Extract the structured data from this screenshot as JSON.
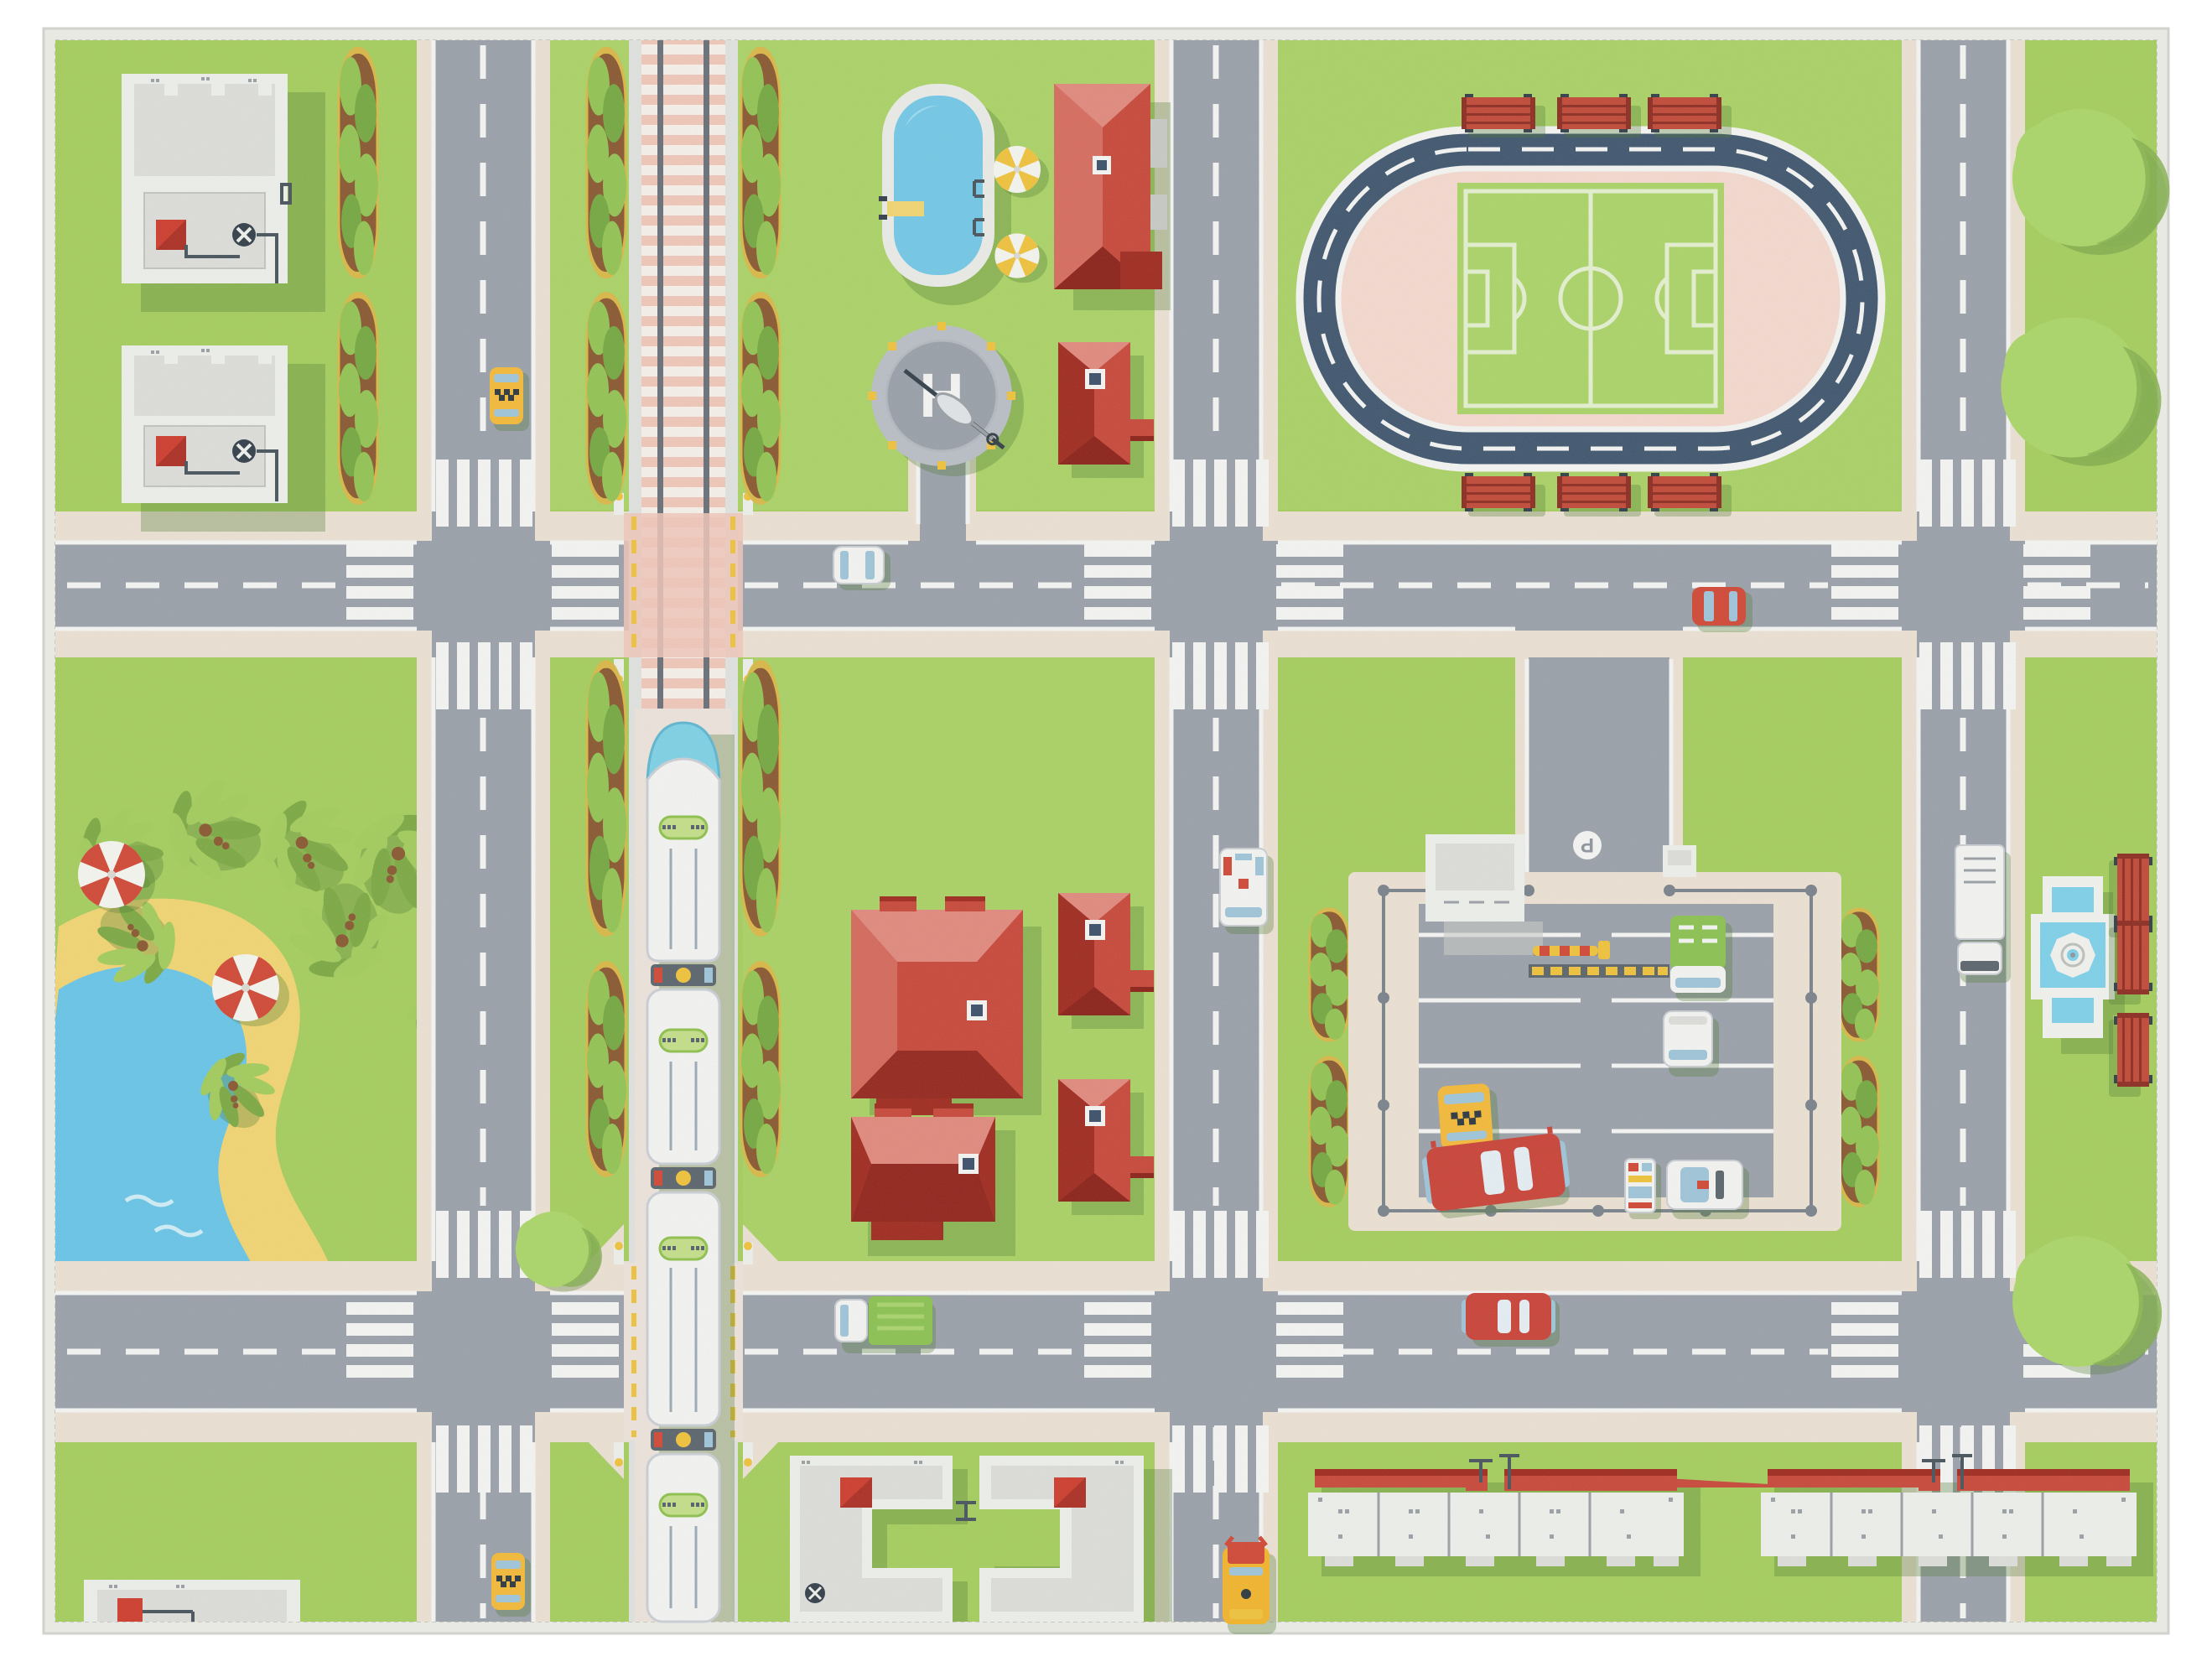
{
  "scene": {
    "description": "Top-down children's play rug printed with a toy city: grid of grey roads, railway with passenger train, stadium with running track and soccer pitch, swimming pool, helipad, parking lot with cars, pond park with palms, red-roofed houses and white flat-roof buildings",
    "labels": {
      "helipad": "H",
      "parking_sign": "P"
    },
    "features": [
      "white-flat-roof-buildings-top-left",
      "hedge-rows",
      "vertical-road-west",
      "railway-with-train",
      "swimming-pool",
      "helipad",
      "red-roof-houses",
      "stadium-running-track-soccer-field",
      "red-benches",
      "street-trees",
      "pond-park-with-palms-and-umbrellas",
      "parking-lot-with-cars",
      "fountain-square",
      "apartment-blocks-bottom",
      "taxi",
      "police-car",
      "ambulance",
      "red-bus",
      "school-bus",
      "green-truck",
      "white-truck",
      "red-car",
      "white-car"
    ]
  },
  "colors": {
    "page_bg": "#ffffff",
    "rug_binding": "#e9e9e4",
    "rug_binding_edge": "#d2d2cc",
    "grass": "#a5cd5f",
    "grass_light": "#b2d771",
    "shadow_green": "#4e7a33",
    "road": "#9ba1aa",
    "road_line": "#f3f4f2",
    "sidewalk": "#eae0d2",
    "rail_pink": "#eec6b8",
    "rail_tie": "#f4efe8",
    "rail_steel": "#6b7178",
    "rail_edge": "#dfe1de",
    "rail_south": "#ebe2da",
    "hedge_soil": "#8a5a33",
    "hedge_green": "#93c355",
    "hedge_green_dark": "#76a843",
    "hedge_ring": "#d9b84a",
    "building_white": "#eceeea",
    "building_mid": "#dcddd9",
    "building_shade": "#c7c9c5",
    "building_line": "#9aa0a5",
    "pipe": "#4a565e",
    "chimney_red": "#cd3f30",
    "roof_red": "#c74a3c",
    "roof_red_dark": "#a02d22",
    "roof_red_deep": "#8c241b",
    "roof_red_light": "#e08a7e",
    "skylight_frame": "#f3f4f1",
    "skylight_glass": "#3f526b",
    "pool_deck": "#e9eae6",
    "pool_water": "#74c7e5",
    "pool_water_light": "#a2dcf0",
    "pond_water": "#6ac4e6",
    "pond_sand": "#f0d473",
    "palm_light": "#a3cb5e",
    "palm_dark": "#7da945",
    "palm_trunk": "#8a5a33",
    "track_navy": "#42586f",
    "infield_pink": "#f3d8cd",
    "pitch_green": "#abd369",
    "pitch_line": "#e3efcf",
    "bench_red": "#c14b3a",
    "bench_red_dark": "#8e2f24",
    "bench_metal": "#35414b",
    "fountain_white": "#f0f1ed",
    "fountain_water": "#7fd0e8",
    "tree_green": "#abd56a",
    "tree_green_dark": "#84af50",
    "helipad_ring": "#b9bec5",
    "helipad_inner": "#9aa0a9",
    "taxi_yellow": "#f2b93b",
    "car_red": "#d04a38",
    "car_white": "#f2f3f0",
    "car_glass": "#9fc4d8",
    "bus_red": "#c9453a",
    "truck_green": "#8cc153,",
    "school_yellow": "#f0b42f",
    "barrier_yellow": "#eec23e",
    "post_dark": "#5d666e",
    "sign_gray": "#8e959c"
  }
}
